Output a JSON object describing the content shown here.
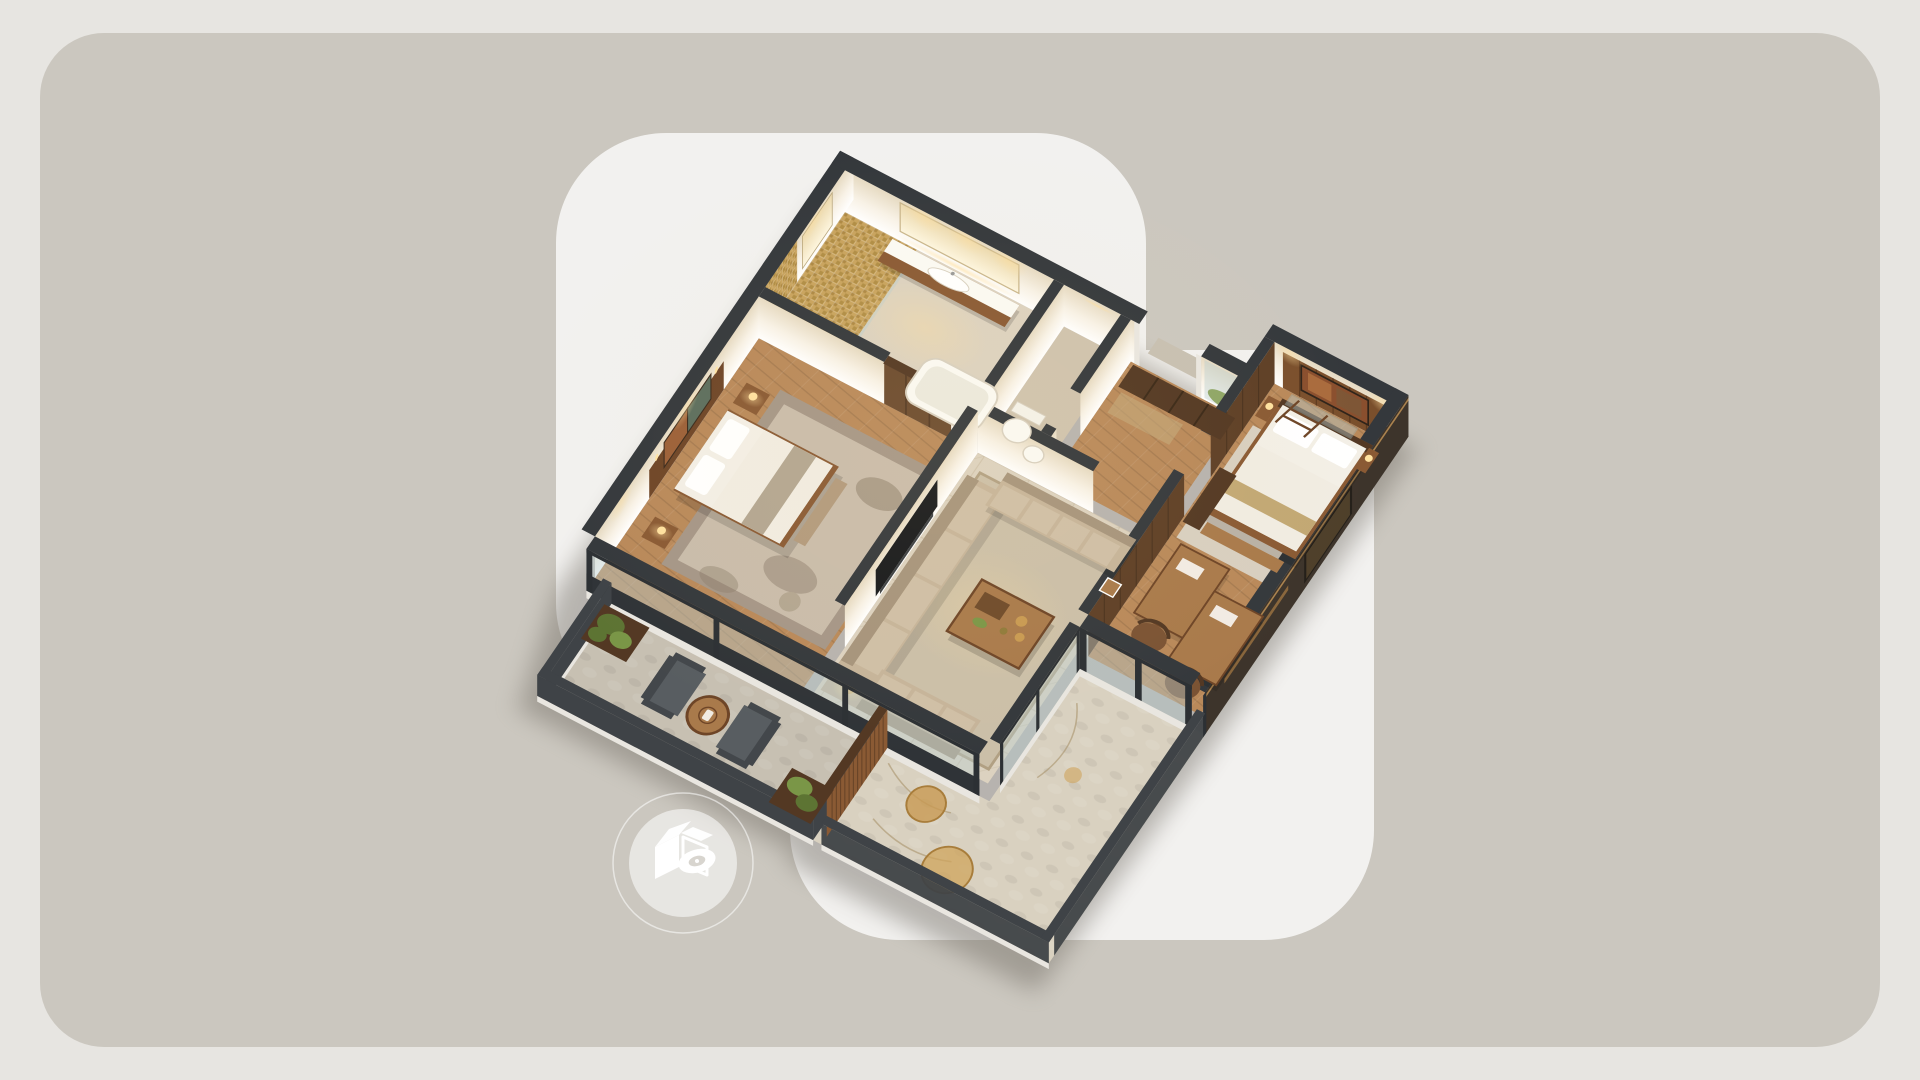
{
  "canvas": {
    "width": 1920,
    "height": 1080
  },
  "scene": {
    "type": "isometric-3d-floorplan-render",
    "rooms": [
      "bathroom",
      "wc",
      "entry-hall",
      "bedroom-left",
      "living-room",
      "bedroom-right",
      "balcony",
      "terrace"
    ],
    "no_visible_text": true
  },
  "badge": {
    "icon": "3d-view-cube-eye-icon"
  },
  "palette": {
    "page_bg": "#e7e5e1",
    "stage_bg": "#cbc7bf",
    "card_bg": "#f2f1ef",
    "wall_dark": "#34383c",
    "cream_hi": "#f8f2e7",
    "cream_lo": "#e6dac2",
    "mirror_hi": "#fdf6e0",
    "mirror_lo": "#ecd9ae",
    "slab": "#e9e6e0",
    "wood_floor": "#b9895a",
    "wood_furniture": "#8a5a34",
    "wood_furniture_light": "#a97a4b",
    "wood_dark": "#533823",
    "wood_mid": "#5e3f26",
    "marble": "#dcd2c0",
    "marble2": "#cfc3ae",
    "mosaic": "#c8a35e",
    "mosaic2": "#a8843f",
    "stone": "#c7c0b2",
    "terrace": "#d9d1c0",
    "rug_taupe": "#a59687",
    "rug_light": "#c9bcab",
    "rug_living": "#cbbfa8",
    "rug_cream": "#d8cfc0",
    "sofa": "#c6b49a",
    "sofa_dark": "#a6947c",
    "sofa_light": "#cfbfa6",
    "linen": "#f3efe6",
    "linen_shade": "#ddd5c6",
    "throw": "#b3a691",
    "glass": "#b8cdd0",
    "frame": "#2c3034",
    "tv": "#17191c",
    "chair_gray": "#585d61",
    "chair_gray_dark": "#43474b",
    "plant": "#5d7433",
    "plant2": "#7a9647",
    "gold": "#c89a52",
    "glow": "#ffdf9e",
    "rail": "#3f4347",
    "bronze": "#3d342b",
    "porcelain": "#fbfaf4",
    "shadow": "#6f6b62",
    "badge_ring": "#ffffff",
    "badge_fill": "rgba(255,255,255,0.55)",
    "badge_hole": "#d8d5cf"
  }
}
